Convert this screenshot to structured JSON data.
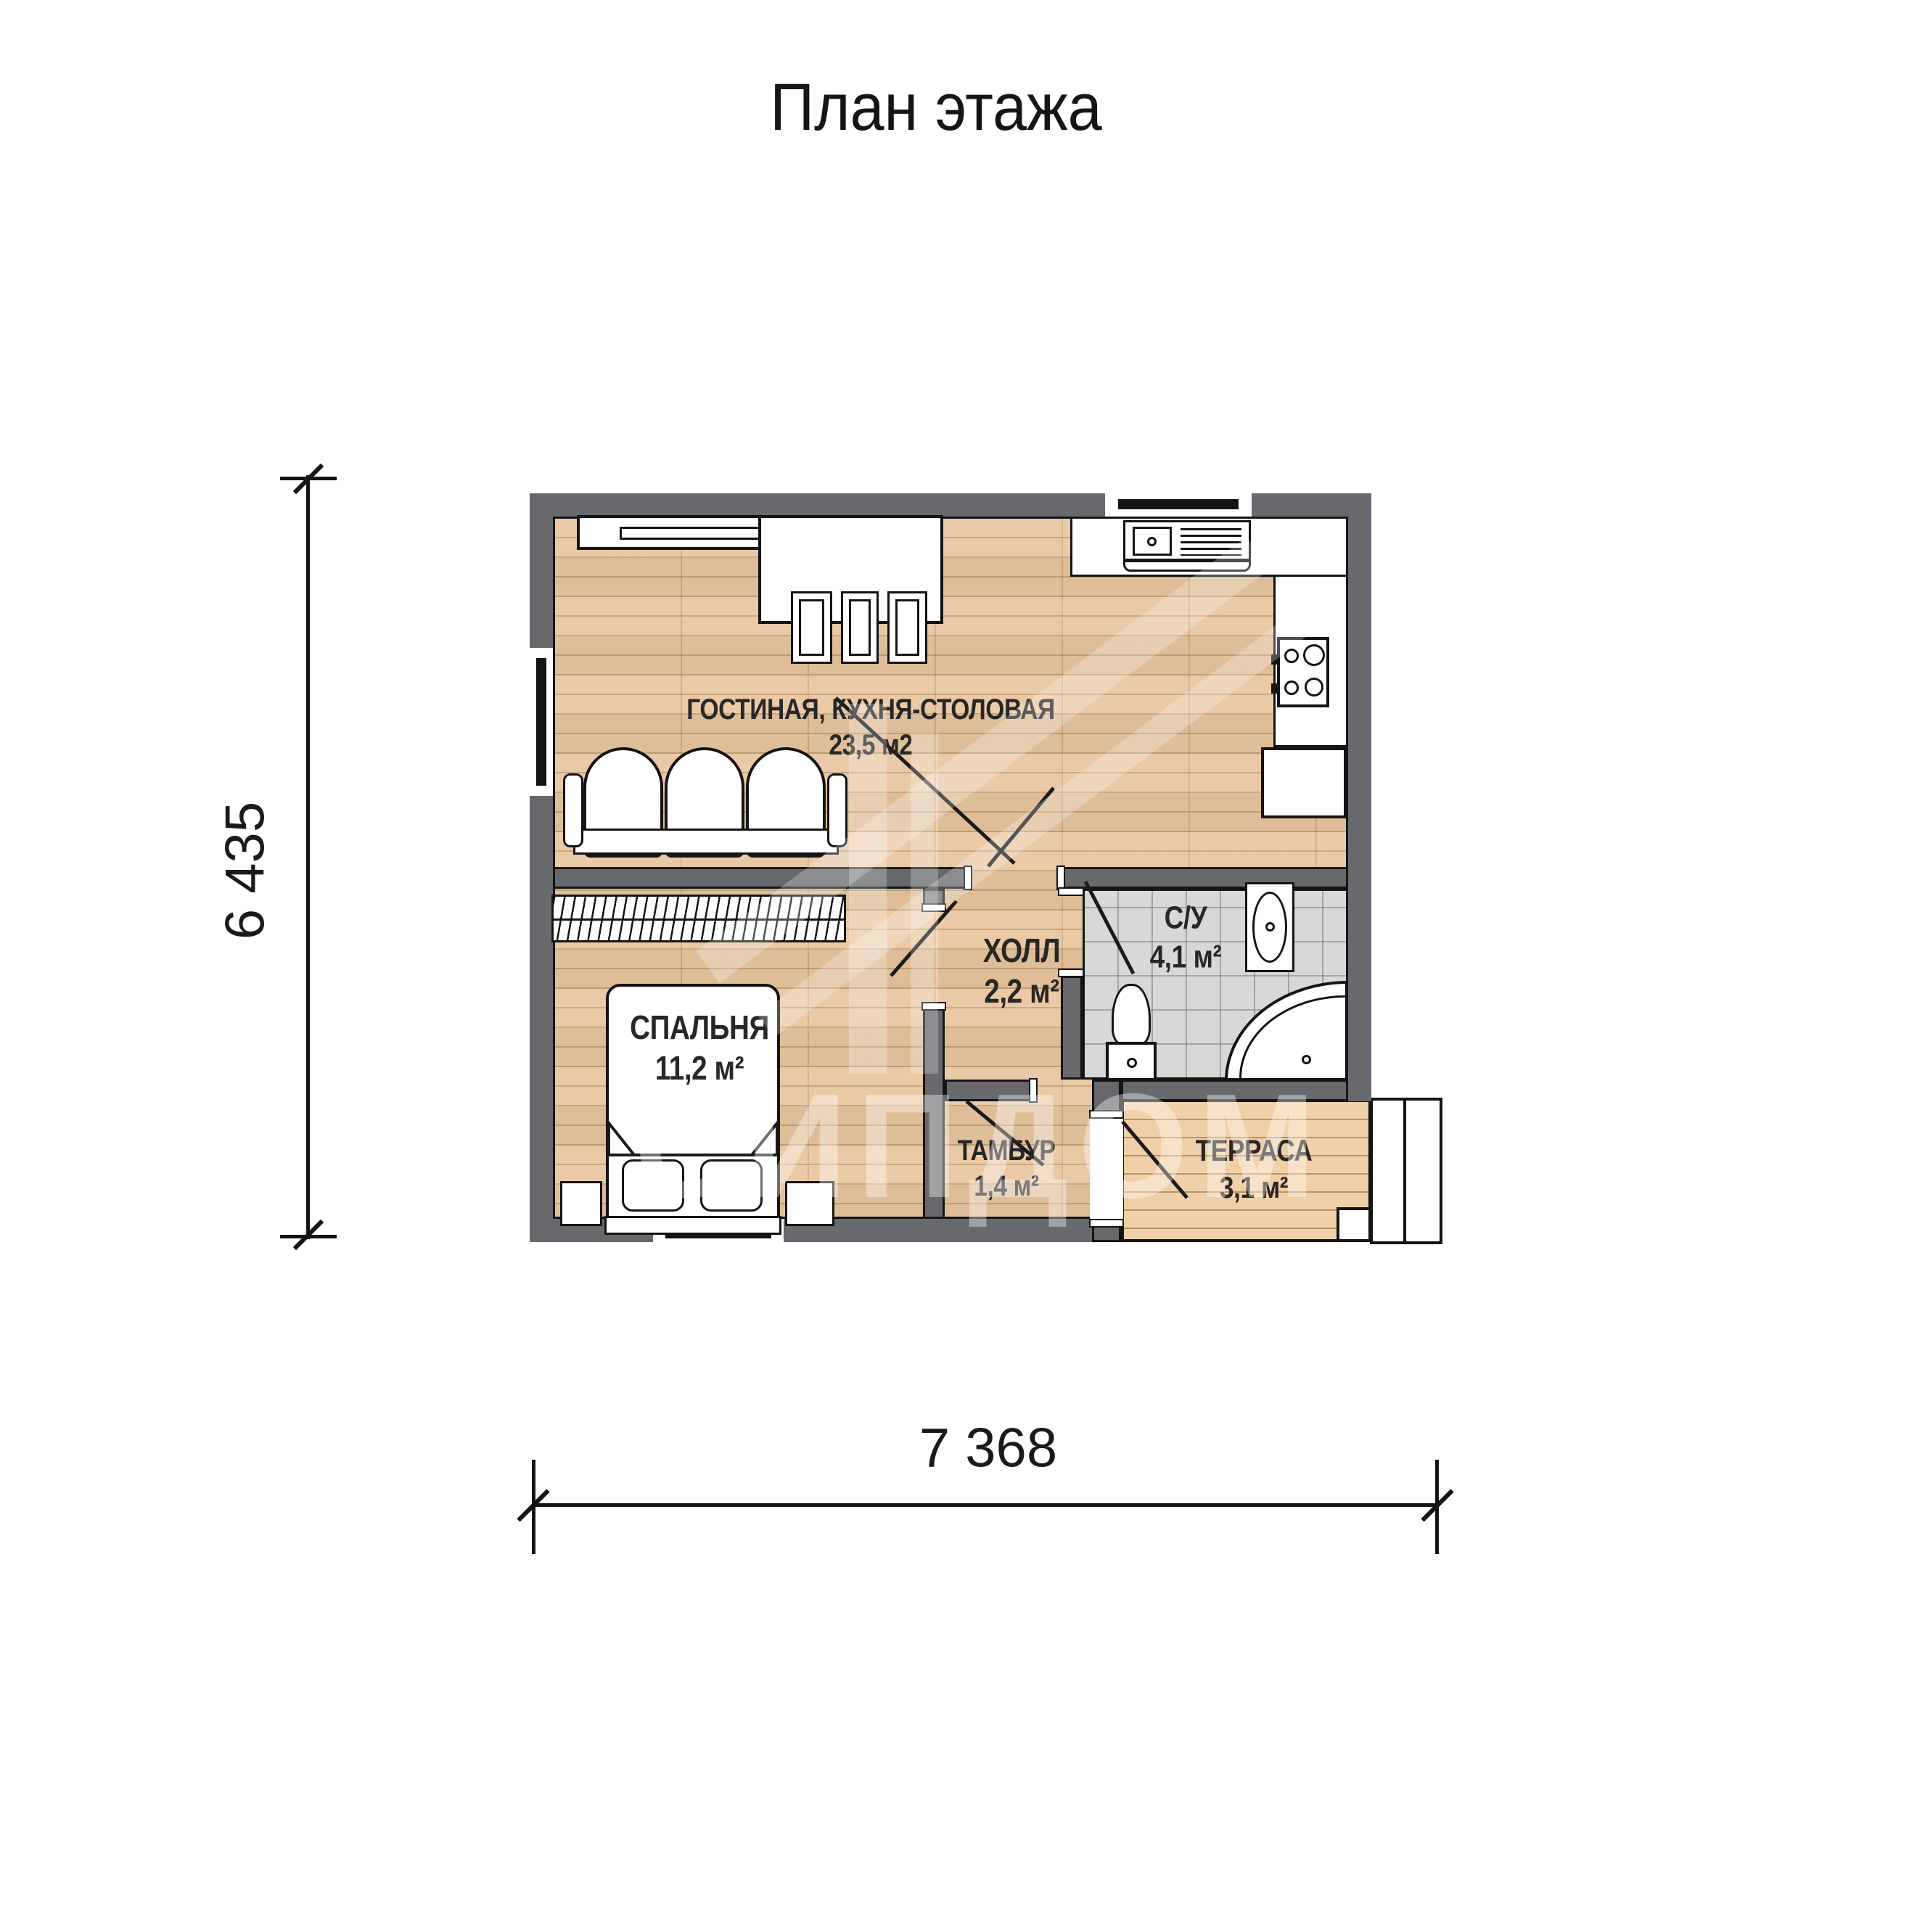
{
  "title": "План этажа",
  "dimensions": {
    "width_label": "7 368",
    "height_label": "6 435"
  },
  "rooms": [
    {
      "name": "ГОСТИНАЯ, КУХНЯ-СТОЛОВАЯ",
      "area": "23,5 м2"
    },
    {
      "name": "СПАЛЬНЯ",
      "area": "11,2 м²"
    },
    {
      "name": "ХОЛЛ",
      "area": "2,2 м²"
    },
    {
      "name": "С/У",
      "area": "4,1 м²"
    },
    {
      "name": "ТАМБУР",
      "area": "1,4 м²"
    },
    {
      "name": "ТЕРРАСА",
      "area": "3,1 м²"
    }
  ],
  "watermark": "СИПДОМ",
  "colors": {
    "wall": "#67696d",
    "wood": "#e8c69f",
    "tile": "#d8d8d6",
    "deck": "#f0d0a8",
    "line": "#141414",
    "label": "#272727"
  }
}
